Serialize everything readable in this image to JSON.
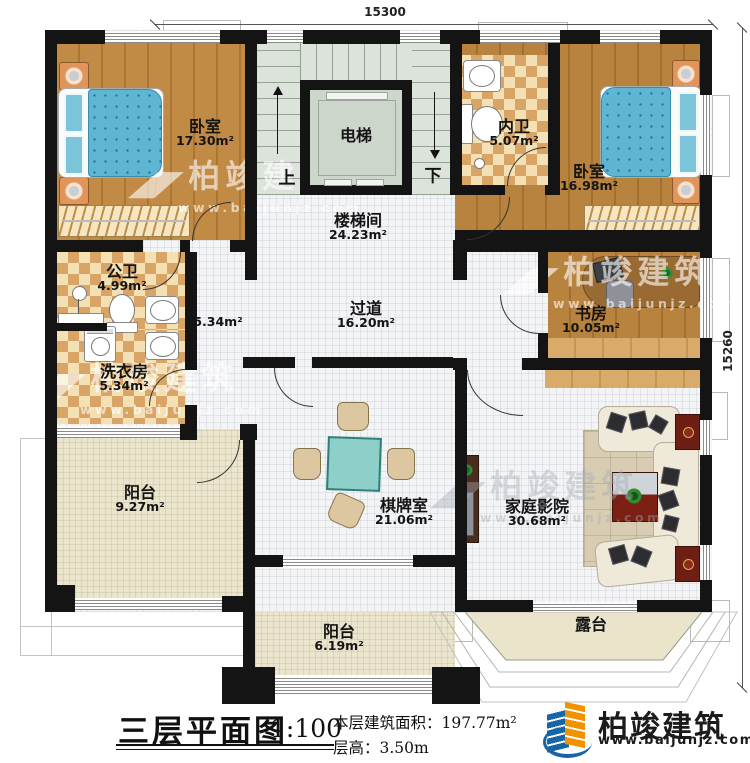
{
  "plan": {
    "dimensions": {
      "top": "15300",
      "right": "15260"
    },
    "rooms": {
      "bedroom1": {
        "name": "卧室",
        "area": "17.30m²"
      },
      "elevator": {
        "name": "电梯"
      },
      "stairwell": {
        "name": "楼梯间",
        "area": "24.23m²"
      },
      "stair_up": "上",
      "stair_down": "下",
      "inner_bath": {
        "name": "内卫",
        "area": "5.07m²"
      },
      "bedroom2": {
        "name": "卧室",
        "area": "16.98m²"
      },
      "public_bath": {
        "name": "公卫",
        "area": "4.99m²"
      },
      "laundry": {
        "name": "洗衣房",
        "area": "5.34m²"
      },
      "hall_small_area": "5.34m²",
      "corridor": {
        "name": "过道",
        "area": "16.20m²"
      },
      "study": {
        "name": "书房",
        "area": "10.05m²"
      },
      "balcony1": {
        "name": "阳台",
        "area": "9.27m²"
      },
      "chess_room": {
        "name": "棋牌室",
        "area": "21.06m²"
      },
      "home_theater": {
        "name": "家庭影院",
        "area": "30.68m²"
      },
      "balcony2": {
        "name": "阳台",
        "area": "6.19m²"
      },
      "terrace": {
        "name": "露台"
      }
    }
  },
  "title_block": {
    "title": "三层平面图",
    "scale": "1:100",
    "area_label": "本层建筑面积：",
    "area_value": "197.77m²",
    "floor_height_label": "层高：",
    "floor_height_value": "3.50m"
  },
  "branding": {
    "company": "柏竣建筑",
    "website": "www.baijunjz.com"
  },
  "watermark": {
    "brand": "柏竣建筑",
    "url": "www.baijunjz.com",
    "mark": "◢◤"
  },
  "colors": {
    "wall": "#141414",
    "wood_floor": "#b8833f",
    "tile_dark": "#d8a566",
    "tile_light": "#f4e0b5",
    "stair": "#dce3da",
    "bed_blue": "#5fb6d3",
    "table_teal": "#8ed0c9",
    "balcony_beige": "#eae5cc",
    "logo_blue": "#1565a8",
    "logo_orange": "#f39200"
  }
}
